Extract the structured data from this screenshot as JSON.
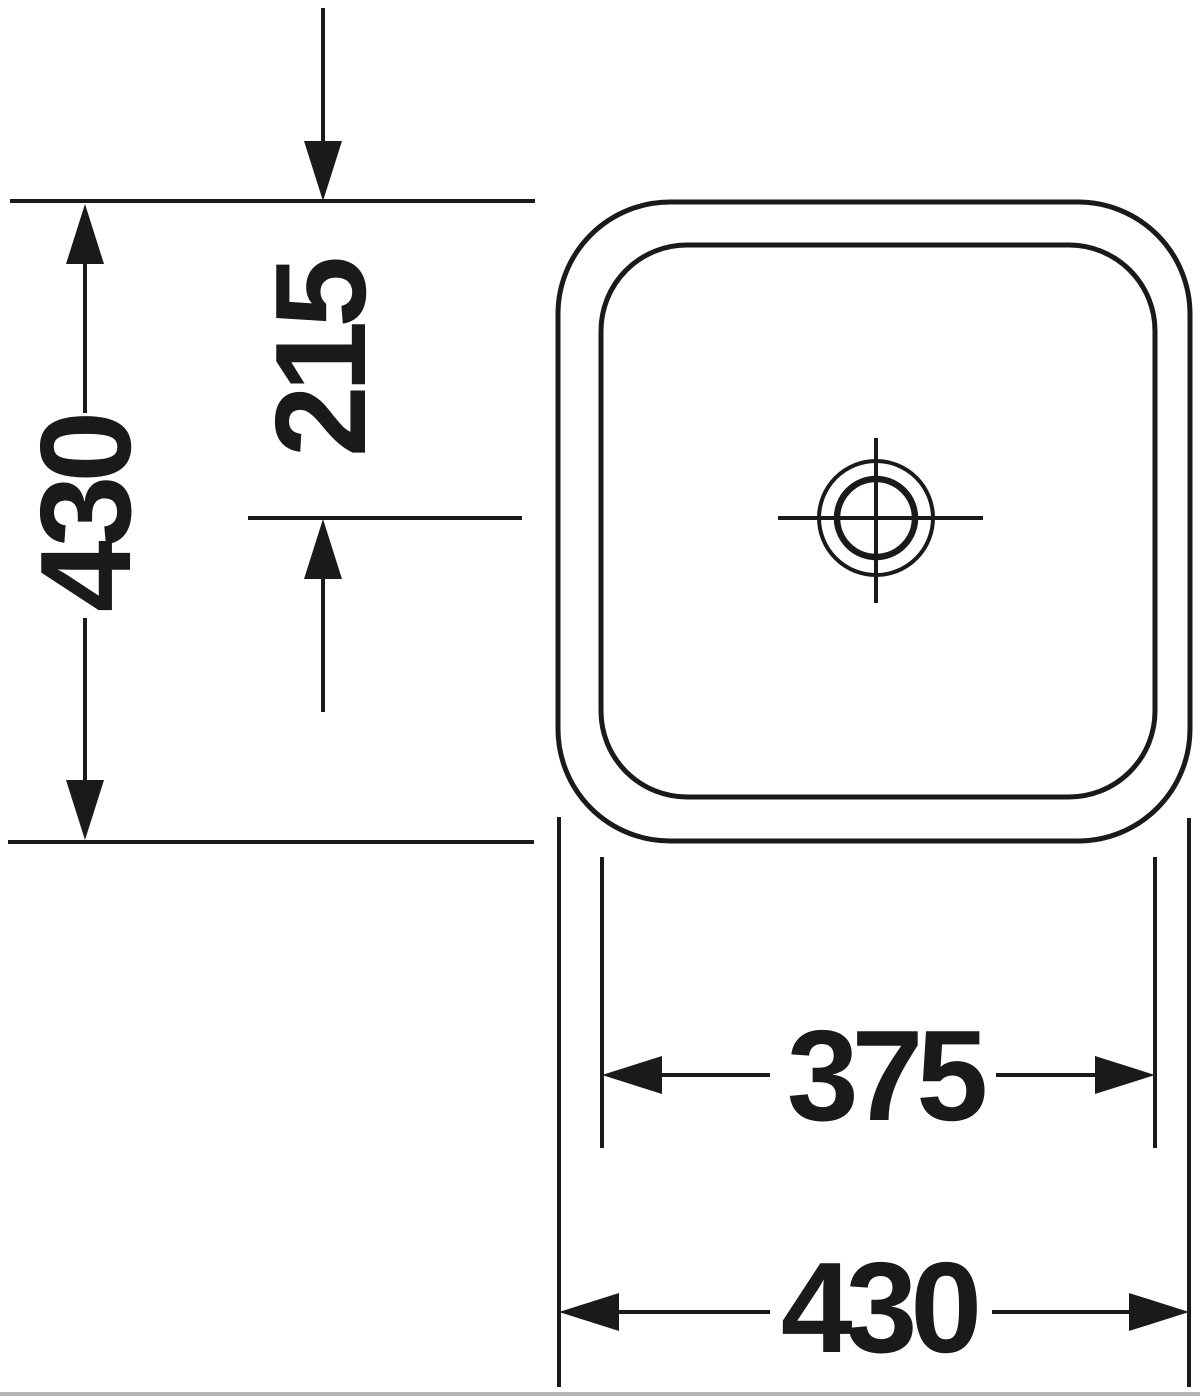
{
  "theme": {
    "ink": "#1a1a1a",
    "paper": "#ffffff",
    "border_gray": "#b4b4b4"
  },
  "drawing": {
    "dimensions": {
      "overall_height_mm": "430",
      "drain_center_offset_mm": "215",
      "bowl_inner_width_mm": "375",
      "overall_width_mm": "430"
    }
  }
}
